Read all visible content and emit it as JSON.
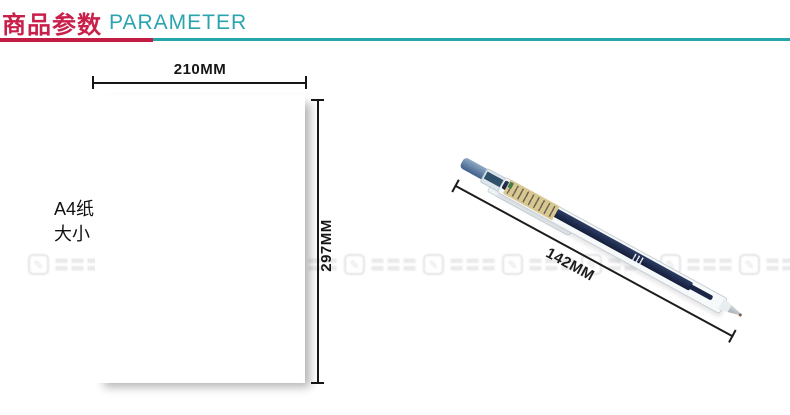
{
  "header": {
    "title_zh": "商品参数",
    "title_en": "PARAMETER",
    "accent_red": "#c31c44",
    "accent_teal": "#26a5ab"
  },
  "paper_diagram": {
    "caption_line1": "A4纸",
    "caption_line2": "大小",
    "width_label": "210MM",
    "height_label": "297MM"
  },
  "pen_diagram": {
    "length_label": "142MM",
    "colors": {
      "button_blue": "#4f6f96",
      "refill_navy": "#1b2647",
      "label_tan": "#d9c78f",
      "tip_metal": "#a8b0b6"
    }
  },
  "watermark": {
    "icon_glyph": "✎",
    "text": "〓〓〓"
  }
}
